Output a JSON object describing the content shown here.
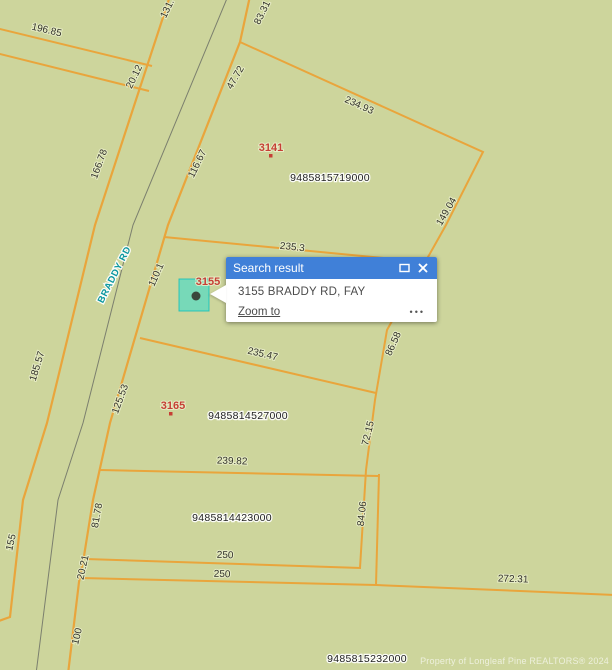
{
  "map": {
    "road_name": "BRADDY RD",
    "watermark": "Property of Longleaf Pine REALTORS® 2024",
    "parcel_ids": [
      "9485815719000",
      "9485814527000",
      "9485814423000",
      "9485815232000"
    ],
    "parcel_numbers": [
      "3141",
      "3155",
      "3165"
    ],
    "dimensions": [
      "196.85",
      "131.",
      "83.31",
      "20.12",
      "47.72",
      "234.93",
      "166.78",
      "116.67",
      "149.04",
      "235.3",
      "110.1",
      "185.57",
      "235.47",
      "86.58",
      "125.53",
      "72.15",
      "239.82",
      "81.78",
      "84.06",
      "155",
      "250",
      "250",
      "20.21",
      "100",
      "272.31"
    ],
    "colors": {
      "background": "#cdd59c",
      "parcel_line": "#e9a53c",
      "road_centerline": "#7b7f6e",
      "dimension_text": "#33332b",
      "parcel_number_red": "#c63f35",
      "road_name_teal": "#0b97a0",
      "marker_cyan": "#00e0e0"
    }
  },
  "popup": {
    "title": "Search result",
    "address": "3155 BRADDY RD, FAY",
    "zoom_to_label": "Zoom to",
    "more_label": "•••",
    "header_color": "#4080d8"
  }
}
